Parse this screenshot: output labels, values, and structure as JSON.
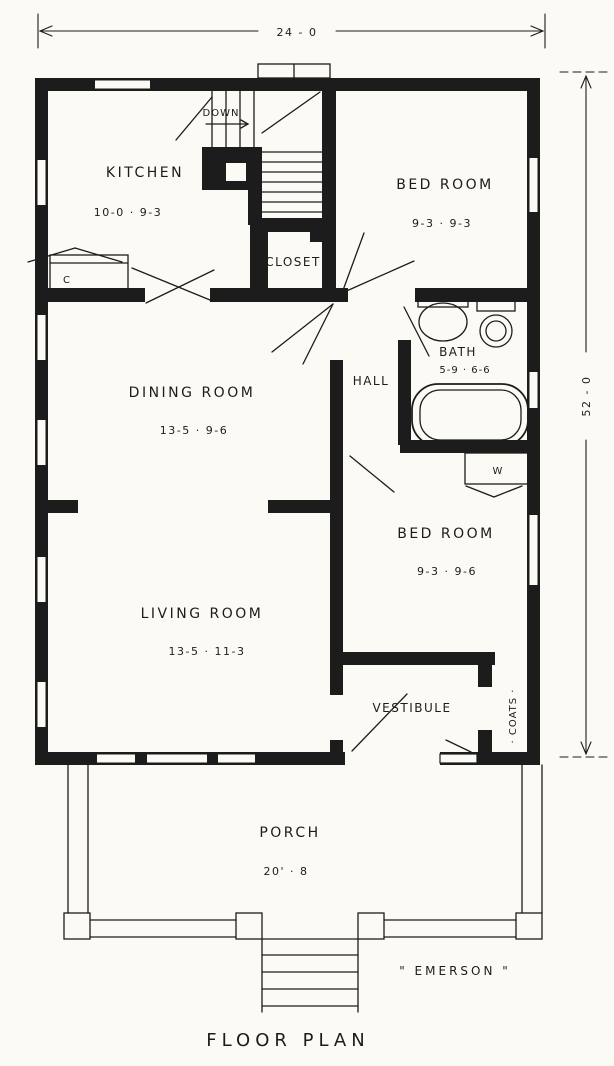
{
  "drawing": {
    "caption": "FLOOR PLAN",
    "house_name": "\" EMERSON \""
  },
  "dimensions": {
    "overall_width": "24 - 0",
    "overall_depth": "52 - 0"
  },
  "rooms": {
    "kitchen": {
      "label": "KITCHEN",
      "size": "10-0 · 9-3"
    },
    "bedroom_front": {
      "label": "BED ROOM",
      "size": "9-3 · 9-3"
    },
    "closet": {
      "label": "CLOSET"
    },
    "bath": {
      "label": "BATH",
      "size": "5-9 · 6-6"
    },
    "hall": {
      "label": "HALL"
    },
    "dining_room": {
      "label": "DINING ROOM",
      "size": "13-5 · 9-6"
    },
    "bedroom_rear": {
      "label": "BED ROOM",
      "size": "9-3 · 9-6"
    },
    "living_room": {
      "label": "LIVING ROOM",
      "size": "13-5 · 11-3"
    },
    "vestibule": {
      "label": "VESTIBULE"
    },
    "coats_closet": {
      "label": "· COATS ·"
    },
    "porch": {
      "label": "PORCH",
      "size": "20' · 8"
    }
  },
  "annotations": {
    "stairs_down": "DOWN",
    "kitchen_counter": "C",
    "wardrobe": "W"
  },
  "colors": {
    "ink": "#1c1c1c",
    "paper": "#fbfaf5"
  }
}
